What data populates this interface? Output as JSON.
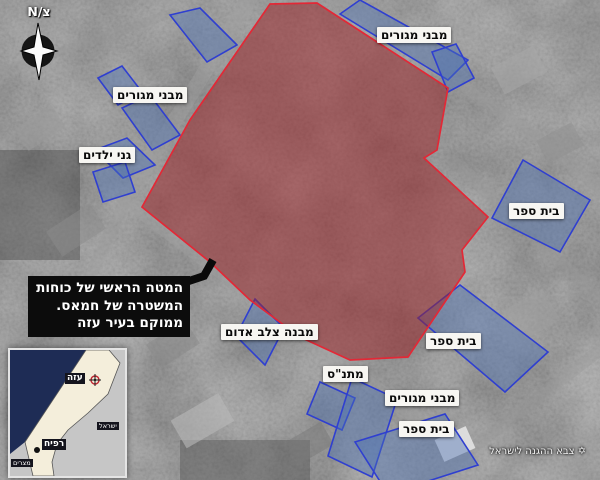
{
  "compass": {
    "label": "צ/N"
  },
  "callout": {
    "lines": [
      "המטה הראשי של כוחות",
      "המשטרה של חמאס.",
      "ממוקם בעיר עזה"
    ]
  },
  "labels": [
    {
      "id": "residential-top",
      "text": "מבני מגורים",
      "x": 377,
      "y": 27
    },
    {
      "id": "residential-left",
      "text": "מבני מגורים",
      "x": 113,
      "y": 87
    },
    {
      "id": "kindergartens",
      "text": "גני ילדים",
      "x": 79,
      "y": 147
    },
    {
      "id": "school-top-right",
      "text": "בית ספר",
      "x": 509,
      "y": 203
    },
    {
      "id": "school-mid-right",
      "text": "בית ספר",
      "x": 426,
      "y": 333
    },
    {
      "id": "red-cross-building",
      "text": "מבנה צלב אדום",
      "x": 221,
      "y": 324
    },
    {
      "id": "community-center",
      "text": "מתנ\"ס",
      "x": 323,
      "y": 366
    },
    {
      "id": "residential-bottom",
      "text": "מבני מגורים",
      "x": 385,
      "y": 390
    },
    {
      "id": "school-bottom",
      "text": "בית ספר",
      "x": 399,
      "y": 421
    }
  ],
  "colors": {
    "target_fill": "#9c2227",
    "target_stroke": "#e32836",
    "building_fill": "#4a6fb5",
    "building_stroke": "#2f3fd0"
  },
  "target": {
    "id": "hamas-police-hq-compound",
    "points": "270,4 317,3 448,88 437,150 424,158 488,217 462,250 465,272 408,357 350,360 300,337 250,300 210,262 142,207 190,120"
  },
  "buildings": [
    {
      "id": "residential-block-top",
      "points": "340,14 360,0 468,60 448,80"
    },
    {
      "id": "residential-block-top-2",
      "points": "432,52 456,44 474,78 448,92"
    },
    {
      "id": "residential-block-left-1",
      "points": "170,15 200,8 237,45 207,62"
    },
    {
      "id": "residential-block-left-2",
      "points": "98,78 122,66 142,92 118,105"
    },
    {
      "id": "residential-block-left-3",
      "points": "122,108 150,95 180,135 152,150"
    },
    {
      "id": "kindergarten-block-1",
      "points": "95,150 127,138 155,165 123,178"
    },
    {
      "id": "kindergarten-block-2",
      "points": "93,172 125,162 135,192 103,202"
    },
    {
      "id": "school-building-top-right",
      "points": "523,160 590,200 560,252 492,218"
    },
    {
      "id": "school-building-mid-right",
      "points": "418,318 460,285 548,352 505,392"
    },
    {
      "id": "red-cross-outline",
      "points": "255,299 284,328 265,365 236,336"
    },
    {
      "id": "community-center-building",
      "points": "320,382 355,398 342,430 307,414"
    },
    {
      "id": "residential-block-bottom",
      "points": "352,378 397,399 372,477 328,456"
    },
    {
      "id": "school-building-bottom",
      "points": "355,442 445,414 478,465 388,494"
    }
  ],
  "inset": {
    "sea_points": "0,0 76,0 15,92 0,104",
    "strip_points": "76,0 99,0 110,13 98,44 78,63 58,80 47,94 42,112 44,126 23,126 15,92",
    "sea_color": "#1e2c55",
    "strip_color": "#f4eedb",
    "land_color": "#c6c6c6",
    "labels": [
      {
        "id": "gaza",
        "text": "עזה",
        "x": 55,
        "y": 23,
        "size": 9,
        "bold": true
      },
      {
        "id": "rafah",
        "text": "רפיח",
        "x": 32,
        "y": 89,
        "size": 9,
        "bold": true
      },
      {
        "id": "israel",
        "text": "ישראל",
        "x": 87,
        "y": 72,
        "size": 6.5,
        "bold": false
      },
      {
        "id": "egypt",
        "text": "מצרים",
        "x": 1,
        "y": 109,
        "size": 6.5,
        "bold": false
      }
    ]
  },
  "credit": {
    "icon": "✡",
    "text": "צבא ההגנה לישראל"
  }
}
